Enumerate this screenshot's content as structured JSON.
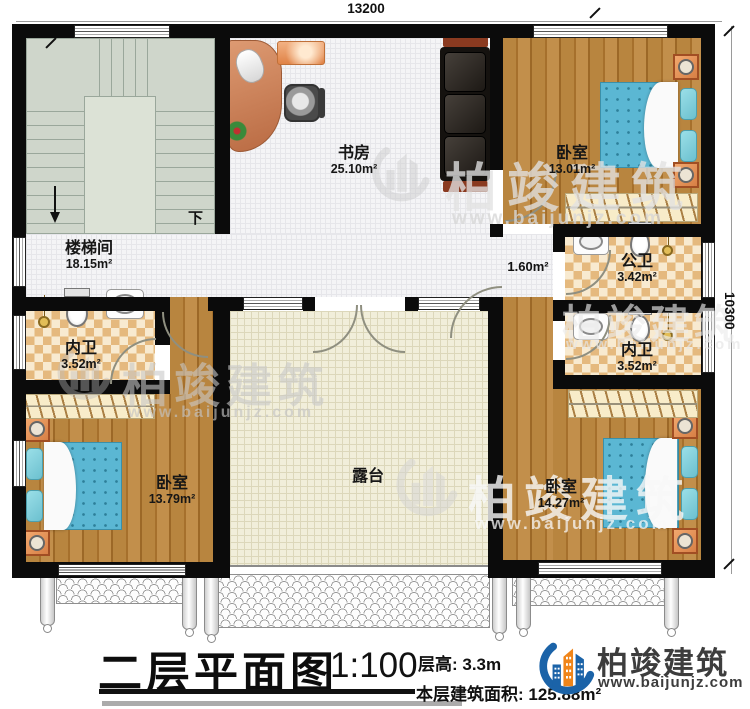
{
  "plan": {
    "dim_top": "13200",
    "dim_right": "10300",
    "stairs_down_label": "下",
    "rooms": {
      "study": {
        "name": "书房",
        "area": "25.10m²"
      },
      "stairwell": {
        "name": "楼梯间",
        "area": "18.15m²"
      },
      "bedroom_tr": {
        "name": "卧室",
        "area": "13.01m²"
      },
      "bath_public": {
        "name": "公卫",
        "area": "3.42m²"
      },
      "bath_left": {
        "name": "内卫",
        "area": "3.52m²"
      },
      "bath_right": {
        "name": "内卫",
        "area": "3.52m²"
      },
      "bedroom_bl": {
        "name": "卧室",
        "area": "13.79m²"
      },
      "bedroom_br": {
        "name": "卧室",
        "area": "14.27m²"
      },
      "terrace": {
        "name": "露台"
      },
      "hall": {
        "area": "1.60m²"
      }
    }
  },
  "title_block": {
    "title": "二层平面图",
    "scale": "1:100",
    "floor_height": "层高: 3.3m",
    "floor_area": "本层建筑面积: 125.88m²"
  },
  "brand": {
    "name": "柏竣建筑",
    "website": "www.baijunjz.com"
  },
  "watermark": {
    "name": "柏竣建筑",
    "website": "www.baijunjz.com"
  },
  "colors": {
    "wall": "#0b0b0b",
    "wood": "#b8853f",
    "bath_tile": "#e5b97e",
    "terrace": "#f1eeda",
    "stair": "#cfd6cb",
    "bed": "#5bb7d3",
    "brand_blue": "#1b63a8",
    "brand_orange": "#f08519"
  }
}
